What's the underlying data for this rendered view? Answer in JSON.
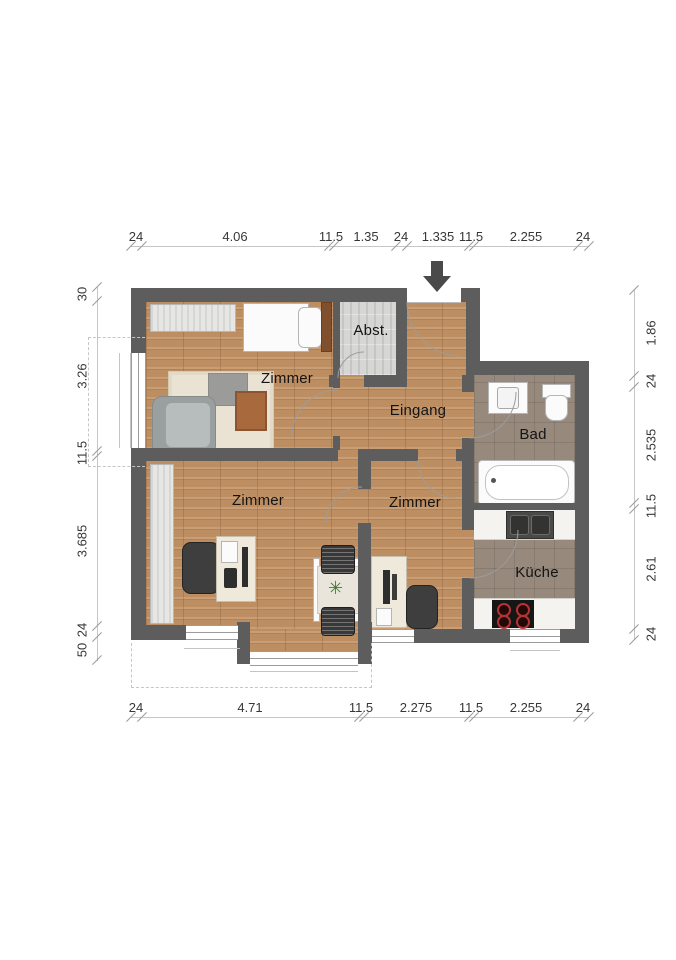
{
  "rooms": {
    "zimmer_top": "Zimmer",
    "abstellraum": "Abst.",
    "eingang": "Eingang",
    "bad": "Bad",
    "zimmer_left": "Zimmer",
    "zimmer_center": "Zimmer",
    "kueche": "Küche"
  },
  "dimensions": {
    "top": [
      "24",
      "4.06",
      "11.5",
      "1.35",
      "24",
      "1.335",
      "11.5",
      "2.255",
      "24"
    ],
    "bottom": [
      "24",
      "4.71",
      "11.5",
      "2.275",
      "11.5",
      "2.255",
      "24"
    ],
    "left": [
      "30",
      "3.26",
      "11.5",
      "3.685",
      "24",
      "50"
    ],
    "right": [
      "1.86",
      "24",
      "2.535",
      "11.5",
      "2.61",
      "24"
    ]
  },
  "icons": {
    "plant": "✳",
    "entrance_arrow": "down-arrow"
  },
  "colors": {
    "wall": "#5d5d5d",
    "wood_floor": "#bd8e62",
    "tile_floor": "#97897c",
    "storage_floor": "#d6d6d4",
    "dimension_text": "#373737",
    "terrace_dash": "#c6c6c6"
  }
}
